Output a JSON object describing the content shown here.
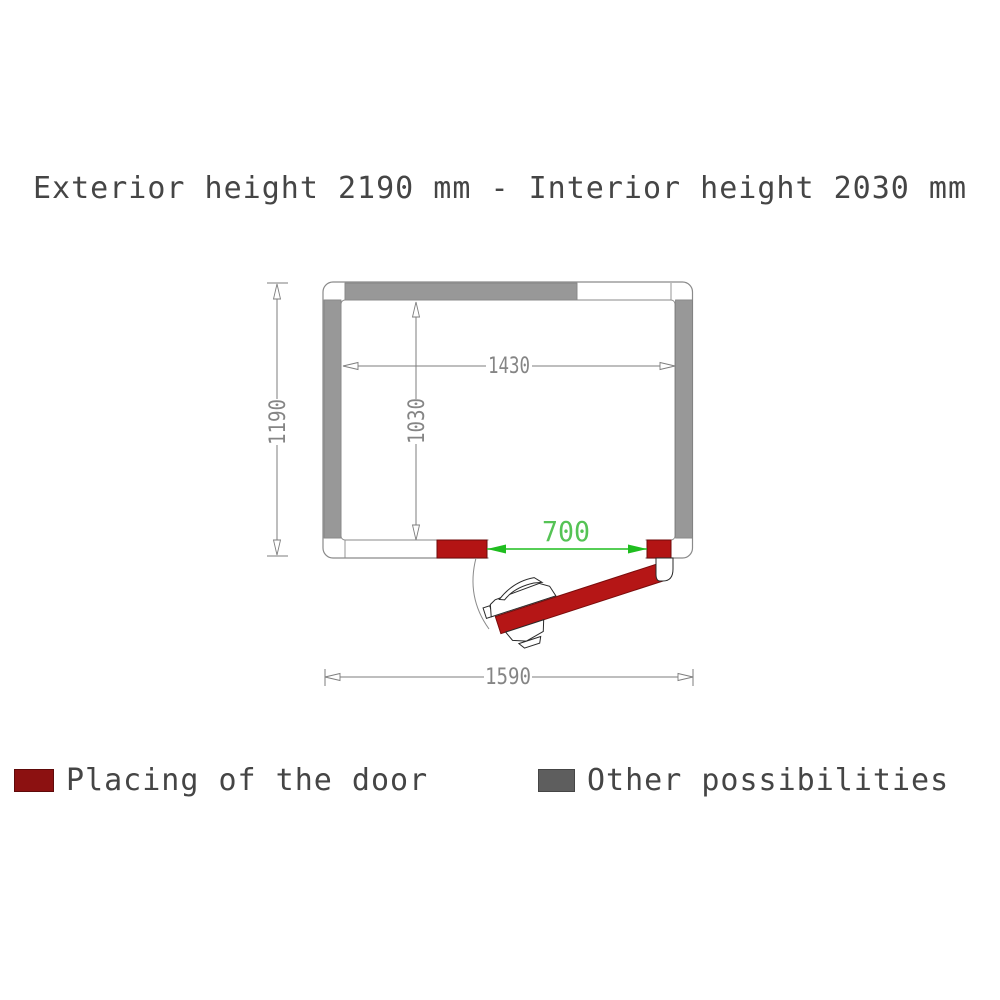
{
  "title": "Exterior height 2190 mm - Interior height 2030 mm",
  "plan": {
    "description": "Top view floor plan of cold room with door placement",
    "dimensions": {
      "exterior_width_mm": "1590",
      "exterior_depth_mm": "1190",
      "interior_width_mm": "1430",
      "interior_depth_mm": "1030",
      "door_width_mm": "700",
      "exterior_height_mm": "2190",
      "interior_height_mm": "2030"
    },
    "colors": {
      "door_red": "#b31414",
      "legend_red": "#8c1111",
      "wall_gray": "#989898",
      "legend_gray": "#5e5e5e",
      "dimension_line_gray": "#7e7e7e",
      "dimension_green": "#1fbd1f",
      "outline_gray": "#8a8a8a"
    }
  },
  "legend": {
    "items": [
      {
        "label": "Placing of the door",
        "color": "#8c1111"
      },
      {
        "label": "Other possibilities",
        "color": "#5e5e5e"
      }
    ]
  }
}
